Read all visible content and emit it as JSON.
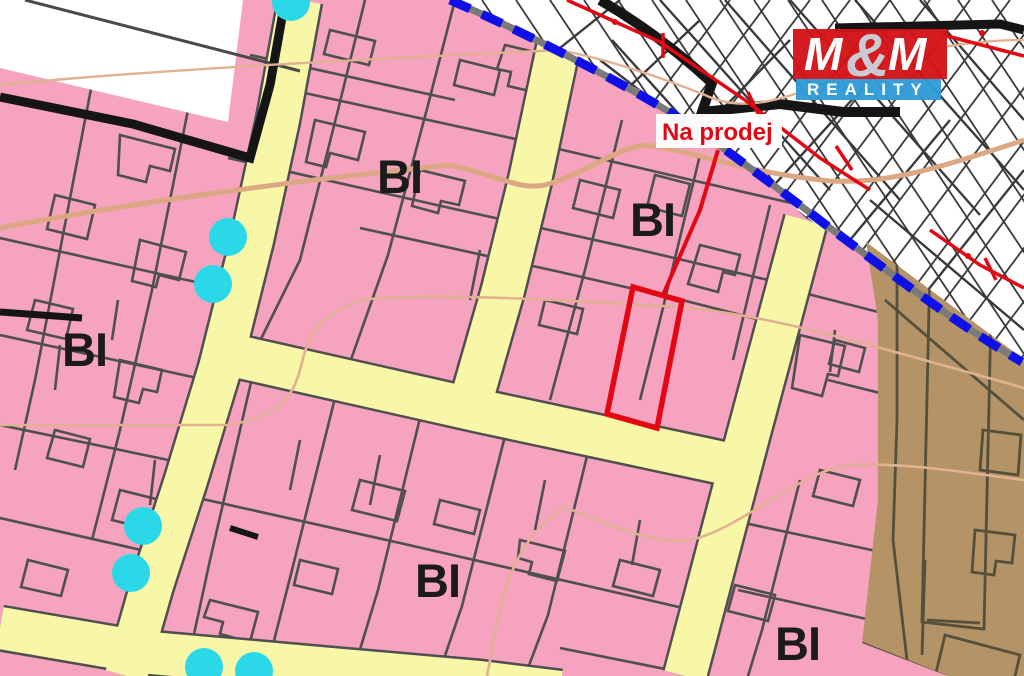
{
  "map": {
    "title": "cadastral zoning map with listing highlight",
    "for_sale_label": "Na prodej",
    "zone_labels": [
      {
        "id": "bi-left",
        "text": "BI"
      },
      {
        "id": "bi-top-middle",
        "text": "BI"
      },
      {
        "id": "bi-top-right",
        "text": "BI"
      },
      {
        "id": "bi-bottom-middle",
        "text": "BI"
      },
      {
        "id": "bi-bottom-right",
        "text": "BI"
      }
    ],
    "logo": {
      "m1": "M",
      "amp": "&",
      "m2": "M",
      "reality": "REALITY"
    },
    "colors": {
      "residential_pink": "#f5a3be",
      "road_yellow": "#f8f7a8",
      "parcel_gray": "#4f4f4f",
      "zone_brown": "#b49366",
      "brown_line": "#55503c",
      "boundary_blue": "#0f0fe8",
      "boundary_gray": "#7a7a7a",
      "contour_tan": "#dca883",
      "highlight_red": "#e30613",
      "dot_cyan": "#2bd8e8",
      "hatch_line": "#3a3a3a",
      "white_area": "#ffffff",
      "black_boundary": "#151515",
      "logo_red": "#d41317",
      "logo_blue": "#2f9bd8"
    }
  }
}
